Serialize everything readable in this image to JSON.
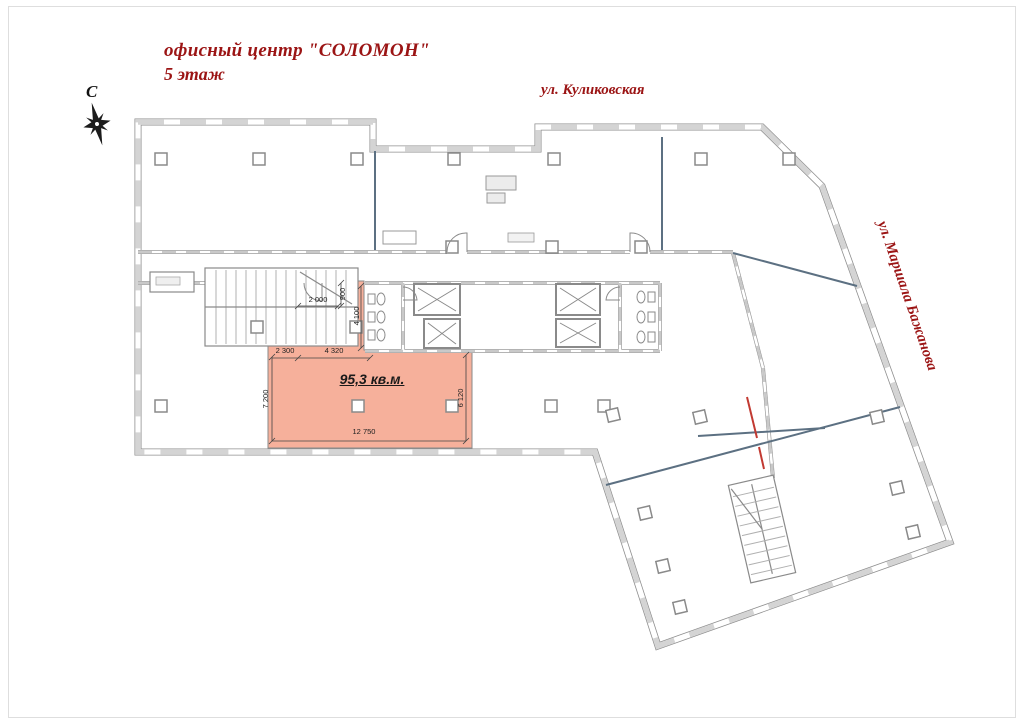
{
  "header": {
    "title_line1": "офисный центр \"СОЛОМОН\"",
    "title_line2": "5 этаж",
    "title_color": "#9b1414"
  },
  "compass": {
    "label": "С"
  },
  "streets": {
    "top": "ул. Куликовская",
    "right": "ул. Маршала Бажанова"
  },
  "highlight_unit": {
    "area_label": "95,3 кв.м.",
    "fill_color": "#f6b09b",
    "dimensions": {
      "top_width": "2 000",
      "stub_height": "900",
      "closet_height": "4 100",
      "left_segment": "2 300",
      "mid_segment": "4 320",
      "left_height": "7 200",
      "right_height": "6 120",
      "bottom_width": "12 750"
    }
  }
}
